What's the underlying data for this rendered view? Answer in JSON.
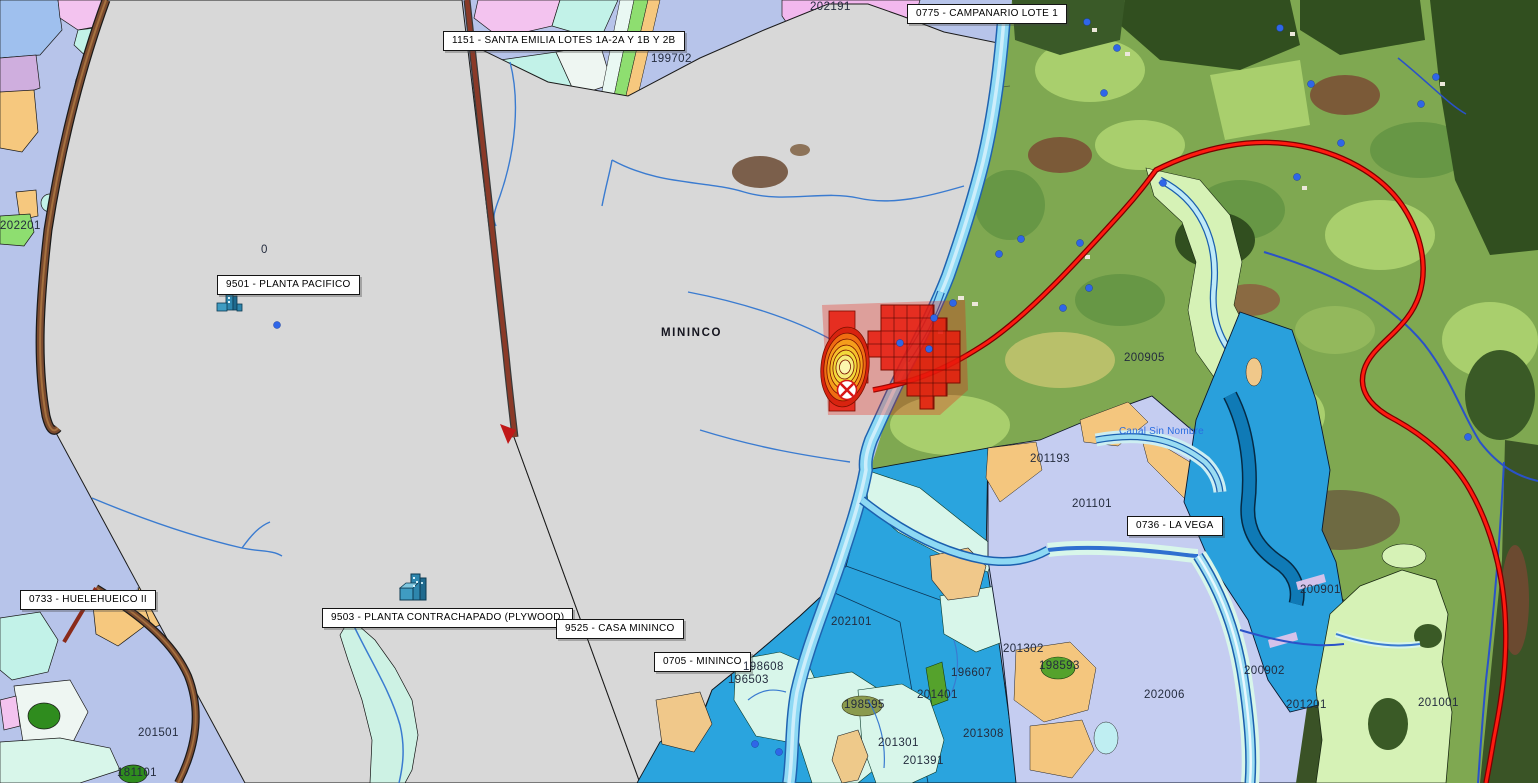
{
  "map": {
    "place_name": "MININCO",
    "water_label": "Canal Sin Nombre",
    "labels": {
      "estates": [
        {
          "id": "1151",
          "text": "1151 - SANTA EMILIA LOTES 1A-2A Y 1B Y 2B"
        },
        {
          "id": "0775",
          "text": "0775 - CAMPANARIO LOTE 1"
        },
        {
          "id": "9501",
          "text": "9501 - PLANTA PACIFICO"
        },
        {
          "id": "0733",
          "text": "0733 - HUELEHUEICO II"
        },
        {
          "id": "9503",
          "text": "9503 - PLANTA CONTRACHAPADO (PLYWOOD)"
        },
        {
          "id": "9525",
          "text": "9525 - CASA MININCO"
        },
        {
          "id": "0705",
          "text": "0705 - MININCO"
        },
        {
          "id": "0736",
          "text": "0736 - LA VEGA"
        }
      ],
      "stands": [
        "202191",
        "199702",
        "202201",
        "201501",
        "202101",
        "198608",
        "196503",
        "196607",
        "201401",
        "201301",
        "201391",
        "201308",
        "201302",
        "198593",
        "198595",
        "201193",
        "201101",
        "200905",
        "200901",
        "200902",
        "201201",
        "202006",
        "201001",
        "181101",
        "0"
      ]
    },
    "markers": {
      "incident_marker": {
        "shape": "circle-with-x",
        "color": "#d81616",
        "x": 847,
        "y": 390
      },
      "plant_icons": [
        {
          "label_ref": "9501 - PLANTA PACIFICO",
          "x": 222,
          "y": 300
        },
        {
          "label_ref": "9503 - PLANTA CONTRACHAPADO (PLYWOOD)",
          "x": 402,
          "y": 582
        }
      ],
      "facility_dot_color": "#2f66e8"
    },
    "palette": {
      "background_lavender": "#b7c4ea",
      "estate_gray": "#d8d8d8",
      "water_parcel_blue": "#2aa4de",
      "wetland_mint": "#d8f6ea",
      "sand_orange": "#f6c87e",
      "pale_green_parcel": "#d6f2b6",
      "forest_dark_green": "#314f1f",
      "field_green": "#7fa851",
      "road_red": "#ff1a10",
      "road_brown": "#7a4a2e",
      "river_cyan": "#8ed9f4",
      "river_blue_line": "#3a7bd0",
      "heat_red": "#e81a0c",
      "contour_yellow": "#f2da3a",
      "pink_parcel": "#f3c3ef"
    }
  }
}
